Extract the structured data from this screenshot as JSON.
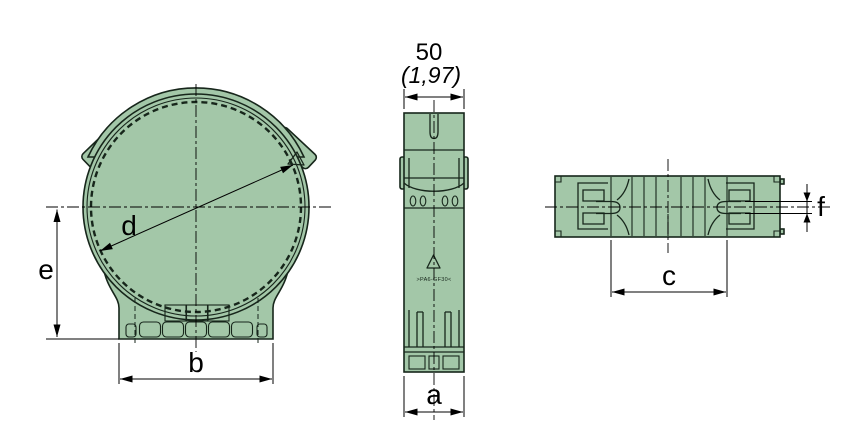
{
  "drawing_labels": {
    "dim_a": "a",
    "dim_b": "b",
    "dim_c": "c",
    "dim_d": "d",
    "dim_e": "e",
    "dim_f": "f"
  },
  "side_view": {
    "width_value_mm": "50",
    "width_value_inch": "(1,97)",
    "material_marking": ">PA6-GF30<"
  },
  "colors": {
    "part_fill": "#a3c7a8",
    "part_outline": "#17261b",
    "dimension_lines": "#000000",
    "background": "#ffffff"
  }
}
